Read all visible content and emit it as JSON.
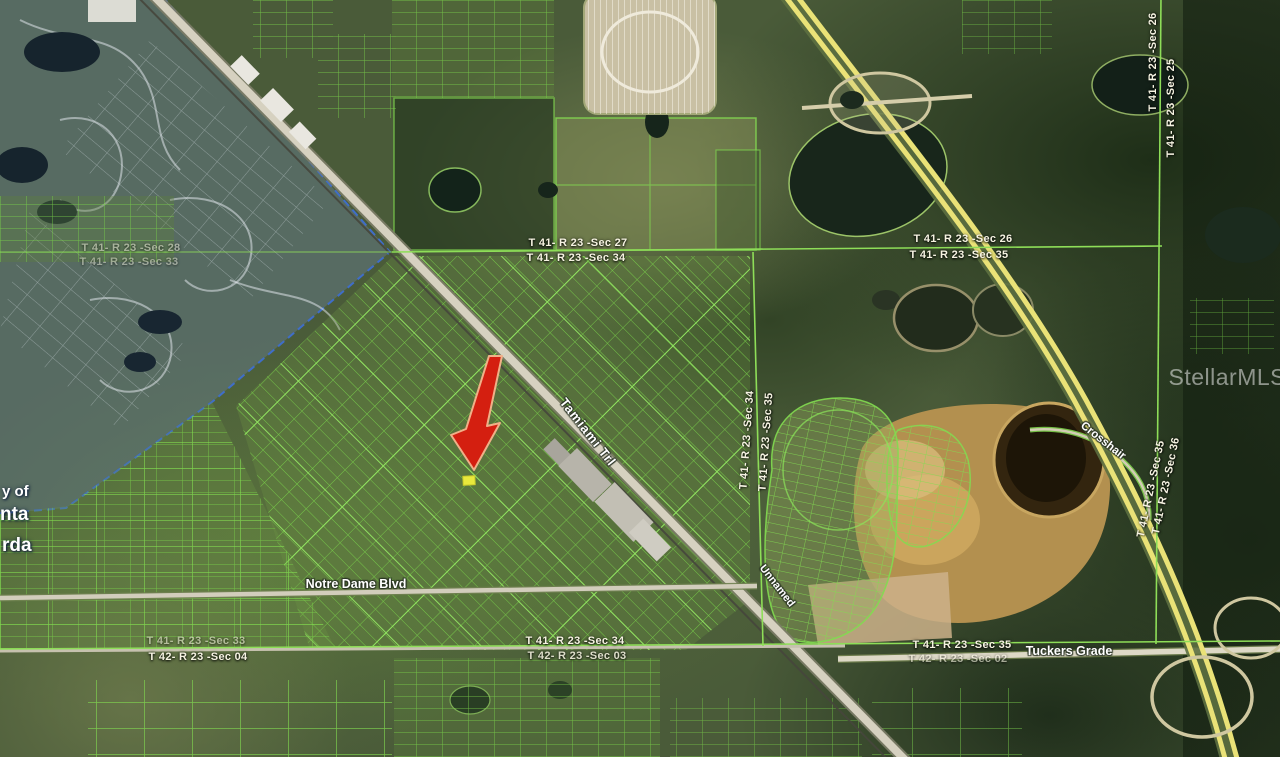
{
  "map": {
    "kind": "aerial-parcel-map",
    "watermark": {
      "text": "StellarMLS"
    },
    "section_labels": [
      {
        "text": "T 41- R 23 -Sec 27"
      },
      {
        "text": "T 41- R 23 -Sec 34"
      },
      {
        "text": "T 41- R 23 -Sec 26"
      },
      {
        "text": "T 41- R 23 -Sec 35"
      },
      {
        "text": "T 41- R 23 -Sec 26"
      },
      {
        "text": "T 41- R 23 -Sec 25"
      },
      {
        "text": "T 41- R 23 -Sec 34"
      },
      {
        "text": "T 41- R 23 -Sec 35"
      },
      {
        "text": "T 41- R 23 -Sec 35"
      },
      {
        "text": "T 41- R 23 -Sec 36"
      },
      {
        "text": "T 41- R 23 -Sec 34"
      },
      {
        "text": "T 42- R 23 -Sec 03"
      },
      {
        "text": "T 41- R 23 -Sec 35"
      },
      {
        "text": "T 42- R 23 -Sec 02"
      },
      {
        "text": "T 41- R 23 -Sec 33"
      },
      {
        "text": "T 42- R 23 -Sec 04"
      },
      {
        "text": "T 41- R 23 -Sec 28"
      },
      {
        "text": "T 41- R 23 -Sec 33"
      }
    ],
    "road_labels": [
      {
        "text": "Tamiami Trl"
      },
      {
        "text": "Notre Dame Blvd"
      },
      {
        "text": "Tuckers Grade"
      },
      {
        "text": "Unnamed"
      },
      {
        "text": "Crosshair"
      }
    ],
    "city_boundary_fragments": [
      {
        "text": "y of"
      },
      {
        "text": "nta"
      },
      {
        "text": "rda"
      }
    ],
    "marker": {
      "kind": "red-arrow",
      "points_to": "highlighted-parcel"
    },
    "colors": {
      "parcel_line_green": "#7fd14c",
      "highlight_yellow": "#e9e93c",
      "arrow_red": "#d41f10",
      "arrow_outline": "#f0b088",
      "city_overlay_blue": "#6c82a0",
      "boundary_dash_blue": "#3f6fd0",
      "highway_yellow": "#eae277",
      "road_gray": "#d6d1c0",
      "dirt_tan": "#b3904f",
      "water_dark": "#17251a",
      "label_white": "#f6f3e2"
    }
  }
}
